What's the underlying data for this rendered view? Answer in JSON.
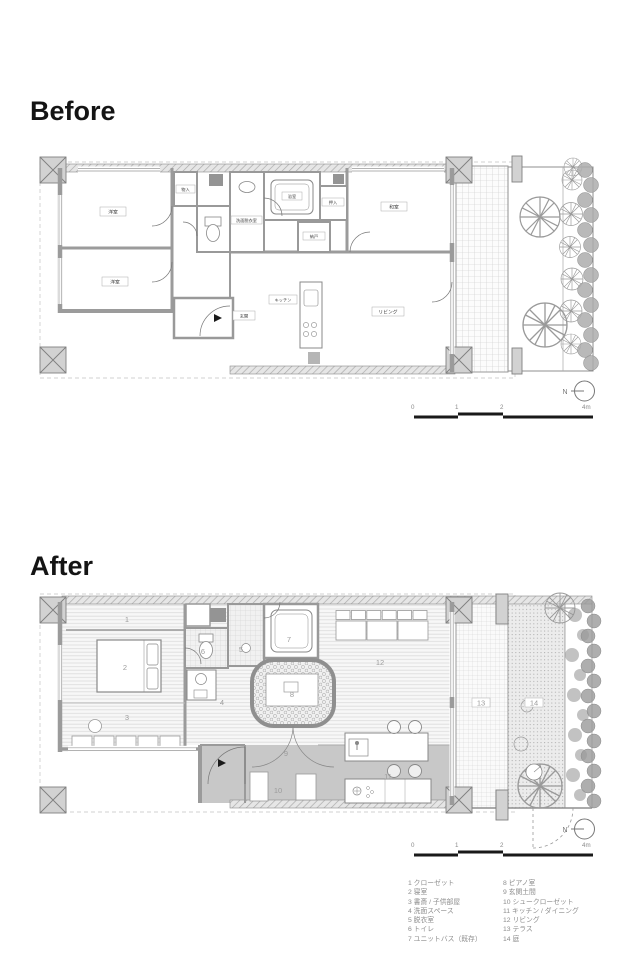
{
  "sections": {
    "before_title": "Before",
    "after_title": "After"
  },
  "compass": {
    "label": "N"
  },
  "scalebar": {
    "t0": "0",
    "t1": "1",
    "t2": "2",
    "t4": "4m"
  },
  "before": {
    "rooms": {
      "bed1": "洋室",
      "bed2": "洋室",
      "washitsu": "和室",
      "living": "リビング",
      "kitchen": "キッチン",
      "genkan": "玄関",
      "bath": "浴室",
      "senmen": "洗面脱衣室",
      "oshiire": "押入",
      "nando": "納戸",
      "monoire": "物入"
    }
  },
  "after": {
    "numbers": [
      "1",
      "2",
      "3",
      "4",
      "5",
      "6",
      "7",
      "8",
      "9",
      "10",
      "11",
      "12",
      "13",
      "14"
    ]
  },
  "legend": {
    "col1": [
      "1 クローゼット",
      "2 寝室",
      "3 書斎 / 子供部屋",
      "4 洗面スペース",
      "5 脱衣室",
      "6 トイレ",
      "7 ユニットバス（既存）"
    ],
    "col2": [
      "8 ピアノ室",
      "9 玄関土間",
      "10 シュークローゼット",
      "11 キッチン / ダイニング",
      "12 リビング",
      "13 テラス",
      "14 庭"
    ]
  },
  "colors": {
    "wall": "#9b9b9b",
    "kitchen_floor": "#c8c8c8",
    "ink": "#141414",
    "annotation": "#8d8d8d"
  }
}
